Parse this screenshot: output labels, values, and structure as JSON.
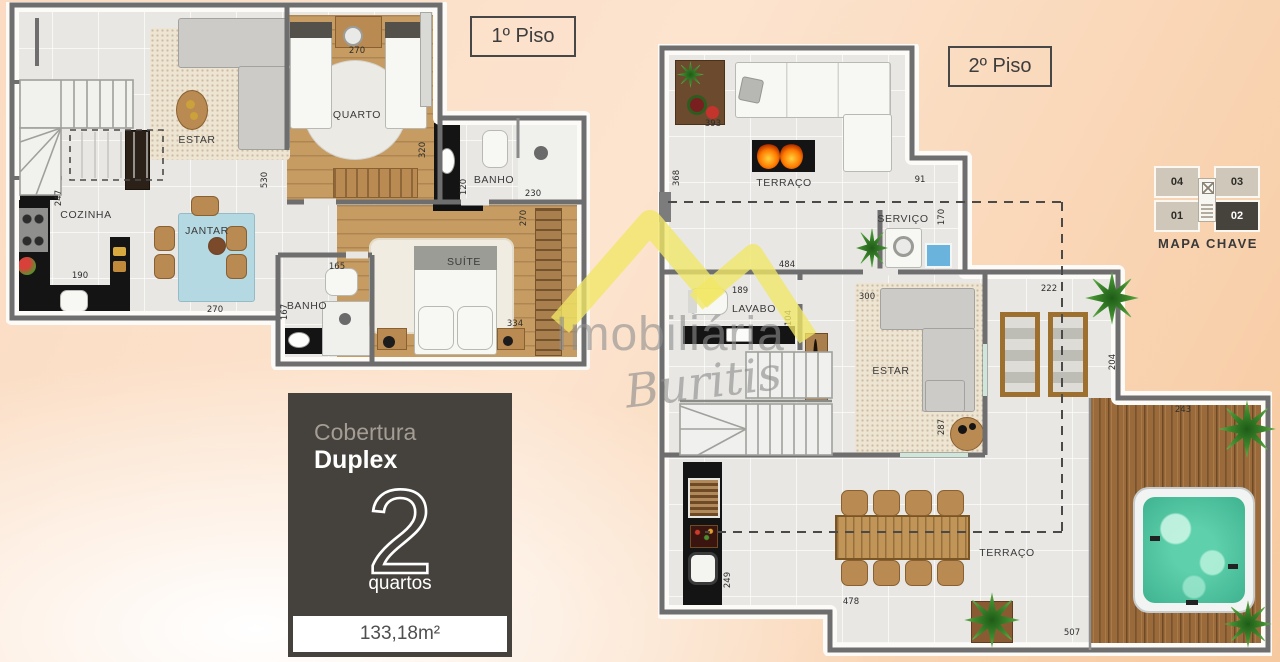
{
  "floor1": {
    "label": "1º Piso",
    "rooms": {
      "estar": "ESTAR",
      "quarto": "QUARTO",
      "cozinha": "COZINHA",
      "jantar": "JANTAR",
      "banho_top": "BANHO",
      "banho_bottom": "BANHO",
      "suite": "SUÍTE"
    },
    "dims": {
      "d247": "247",
      "d530": "530",
      "d270_quarto": "270",
      "d320": "320",
      "d120": "120",
      "d230": "230",
      "d190": "190",
      "d270_jantar": "270",
      "d165": "165",
      "d167": "167",
      "d270_suite": "270",
      "d334": "334"
    }
  },
  "floor2": {
    "label": "2º Piso",
    "rooms": {
      "terraco_top": "TERRAÇO",
      "servico": "SERVIÇO",
      "lavabo": "LAVABO",
      "estar": "ESTAR",
      "terraco_bottom": "TERRAÇO"
    },
    "dims": {
      "d393": "393",
      "d368": "368",
      "d91": "91",
      "d170": "170",
      "d484": "484",
      "d189": "189",
      "d104": "104",
      "d300": "300",
      "d222": "222",
      "d204": "204",
      "d287": "287",
      "d243": "243",
      "d249": "249",
      "d478": "478",
      "d507": "507"
    }
  },
  "key_map": {
    "title": "MAPA CHAVE",
    "unit_04": "04",
    "unit_03": "03",
    "unit_01": "01",
    "unit_02": "02",
    "highlighted_unit": "02"
  },
  "info_card": {
    "category": "Cobertura",
    "type": "Duplex",
    "bedrooms": "2",
    "bedrooms_label": "quartos",
    "area": "133,18m²"
  },
  "watermark": {
    "name": "Imobiliária",
    "script": "Buritis"
  },
  "colors": {
    "accent_yellow": "#f1e765",
    "card_background": "#45413c",
    "highlight_unit": "#46423c"
  }
}
